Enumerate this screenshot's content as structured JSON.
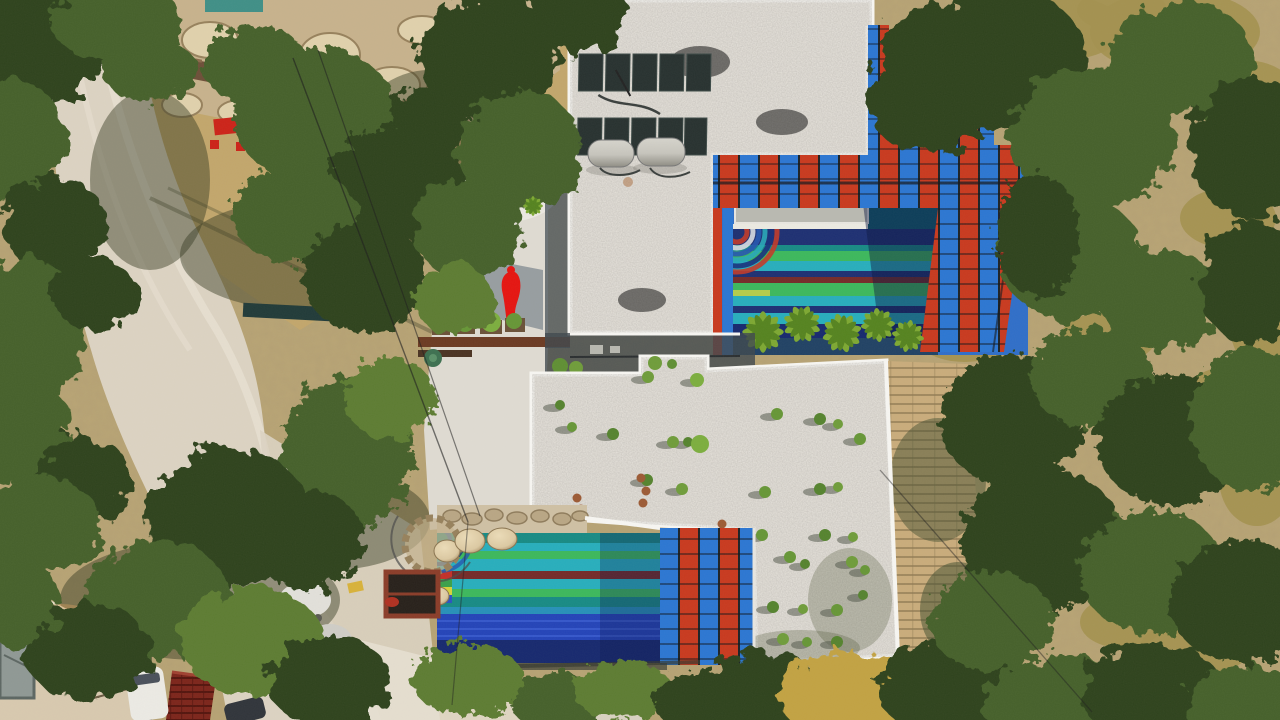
{
  "scene": {
    "type": "aerial-drone-photograph",
    "description": "Top-down drone view of a hillside villa compound: two flat white-gravel roofs with rooftop solar water heaters and potted plants, two mosaic-striped swimming pools shaded by red-and-blue slatted pergolas, a red figure sculpture on a concrete courtyard, olive trees, rocky terrain and dirt roads",
    "elements": [
      "rocky-hillside",
      "stone-retaining-wall",
      "dirt-road",
      "olive-trees",
      "upper-villa-roof",
      "solar-panel-arrays",
      "water-tanks",
      "upper-pool",
      "pool-mosaic-arcs",
      "pergola-canopy-stepped",
      "pergola-canopy-north",
      "pergola-canopy-east",
      "palm-trees",
      "courtyard",
      "red-figure-sculpture",
      "rusty-steel-beam",
      "planter-boxes",
      "lower-villa-roof",
      "roof-plants",
      "wooden-deck",
      "lower-pool",
      "stone-domes",
      "stone-well",
      "rust-frame",
      "neighbor-building-roof",
      "red-shingle-roof",
      "white-van",
      "white-car",
      "dark-suv",
      "debris-pile",
      "power-lines",
      "footpath-steps",
      "garden-hedge"
    ]
  },
  "palette": {
    "ground": "#b9a474",
    "dirt-dry": "#c2a66b",
    "road": "#dcd3c2",
    "road-light": "#e9e2d4",
    "rock": "#e0d1ac",
    "rock-shadow": "#97815c",
    "rock-base": "#c7b28c",
    "wall-stone": "#6d4f38",
    "tree-dark": "#2e431f",
    "tree-mid": "#45602a",
    "tree-bright": "#5d7c33",
    "brush-dry": "#a3914f",
    "autumn": "#c2a243",
    "roof-gravel": "#e9e5de",
    "parapet": "#f7f6f2",
    "panel": "#27312f",
    "panel-frame": "#d8d5cc",
    "tank": "#c6c4bc",
    "pergola-red": "#c8391e",
    "pergola-blue": "#2b76d2",
    "pergola-gap": "#1c2126",
    "pool-deck-blue": "#2f6ec8",
    "walkway": "#b9b9b1",
    "st-navy": "#1d2f72",
    "st-teal": "#178a84",
    "st-green": "#3cb85c",
    "st-turq": "#27aebc",
    "st-maroon": "#742a28",
    "st-lime": "#b5cc4a",
    "st-cover": "#2343b8",
    "st-deep": "#16286e",
    "pool-dark": "#0d5d6e",
    "palm": "#7da832",
    "palm-dark": "#55831f",
    "plant-green": "#669636",
    "concrete": "#dfdbd2",
    "concrete-light": "#ebe8e1",
    "shadow-cool": "#8b9298",
    "rust": "#6b3a22",
    "sculpt-red": "#e51410",
    "deck-wood": "#c9ac7b",
    "deck-line": "#8f7a52",
    "stone-dome": "#dcc9a2",
    "stone-strip": "#cfc0a4",
    "bldg-roof": "#d8c9af",
    "shingle": "#7c241a",
    "car-white": "#eceae4",
    "car-dark": "#2e3338",
    "cable": "#1d1d1d"
  }
}
